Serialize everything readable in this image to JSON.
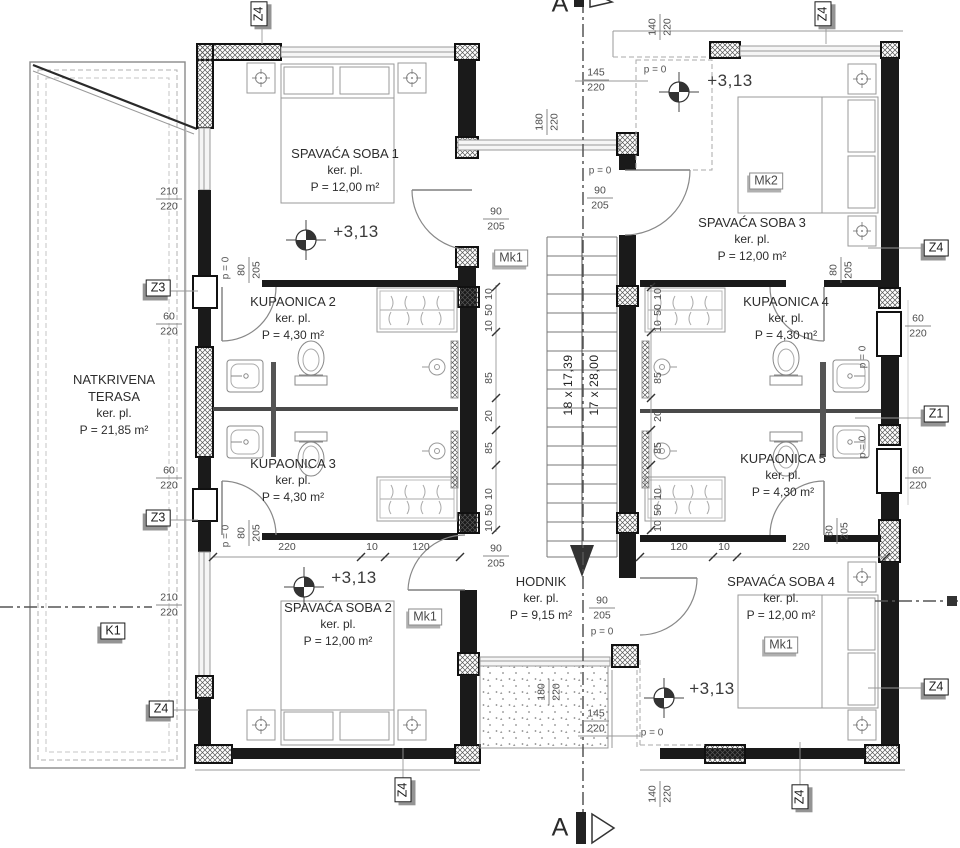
{
  "rooms": {
    "terrace": {
      "name1": "NATKRIVENA",
      "name2": "TERASA",
      "sub": "ker. pl.",
      "area": "P = 21,85 m²"
    },
    "bedroom1": {
      "name": "SPAVAĆA SOBA 1",
      "sub": "ker. pl.",
      "area": "P = 12,00 m²"
    },
    "bedroom2": {
      "name": "SPAVAĆA SOBA 2",
      "sub": "ker. pl.",
      "area": "P = 12,00 m²"
    },
    "bedroom3": {
      "name": "SPAVAĆA SOBA 3",
      "sub": "ker. pl.",
      "area": "P = 12,00 m²"
    },
    "bedroom4": {
      "name": "SPAVAĆA SOBA 4",
      "sub": "ker. pl.",
      "area": "P = 12,00 m²"
    },
    "bath2": {
      "name": "KUPAONICA 2",
      "sub": "ker. pl.",
      "area": "P = 4,30 m²"
    },
    "bath3": {
      "name": "KUPAONICA 3",
      "sub": "ker. pl.",
      "area": "P = 4,30 m²"
    },
    "bath4": {
      "name": "KUPAONICA 4",
      "sub": "ker. pl.",
      "area": "P = 4,30 m²"
    },
    "bath5": {
      "name": "KUPAONICA 5",
      "sub": "ker. pl.",
      "area": "P = 4,30 m²"
    },
    "hall": {
      "name": "HODNIK",
      "sub": "ker. pl.",
      "area": "P = 9,15 m²"
    }
  },
  "stairs": {
    "rise": "18 x 17,39",
    "run": "17 x 28,00"
  },
  "levels": {
    "elev": "+3,13",
    "parapet": "p = 0"
  },
  "tags": {
    "z4": "Z4",
    "z3": "Z3",
    "z1": "Z1",
    "k1": "K1",
    "mk1": "Mk1",
    "mk2": "Mk2"
  },
  "section": {
    "letter": "A"
  },
  "dims": {
    "n210": "210",
    "n220": "220",
    "n205": "205",
    "n180": "180",
    "n145": "145",
    "n140": "140",
    "n120": "120",
    "n90": "90",
    "n85": "85",
    "n80": "80",
    "n60": "60",
    "n50": "50",
    "n20": "20",
    "n10": "10"
  }
}
